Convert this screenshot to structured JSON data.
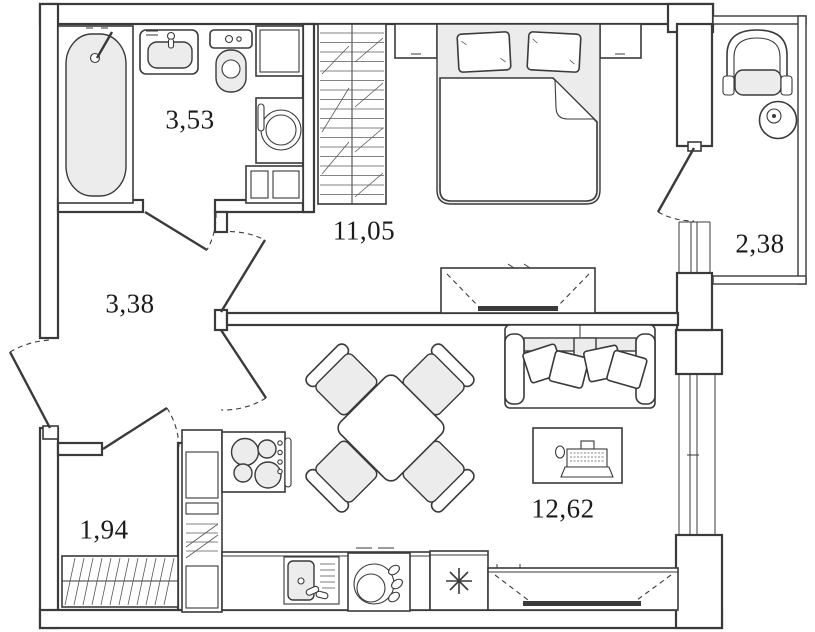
{
  "plan": {
    "type": "apartment-floor-plan",
    "rooms": [
      {
        "id": "bathroom",
        "area_label": "3,53"
      },
      {
        "id": "bedroom",
        "area_label": "11,05"
      },
      {
        "id": "hallway",
        "area_label": "3,38"
      },
      {
        "id": "balcony",
        "area_label": "2,38"
      },
      {
        "id": "storage",
        "area_label": "1,94"
      },
      {
        "id": "living-kitchen",
        "area_label": "12,62"
      }
    ],
    "symbols": {
      "freezer": "✳"
    },
    "colors": {
      "line": "#3a3a3a",
      "fixture_fill": "#ececec",
      "background": "#ffffff"
    }
  }
}
